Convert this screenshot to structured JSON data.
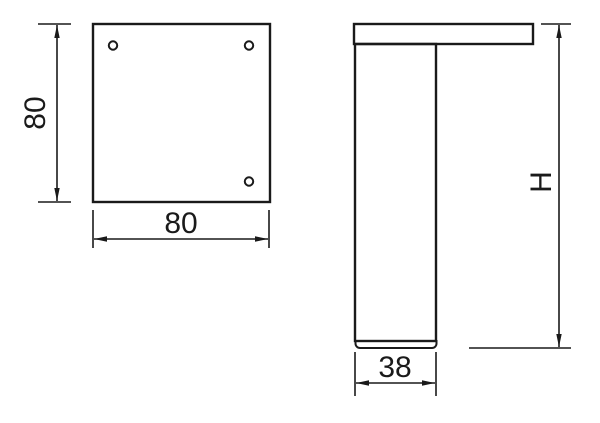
{
  "colors": {
    "line": "#1a1a1a",
    "background": "#ffffff"
  },
  "top_view": {
    "height_dim_label": "80",
    "width_dim_label": "80"
  },
  "side_view": {
    "height_dim_label": "H",
    "foot_width_dim_label": "38"
  }
}
